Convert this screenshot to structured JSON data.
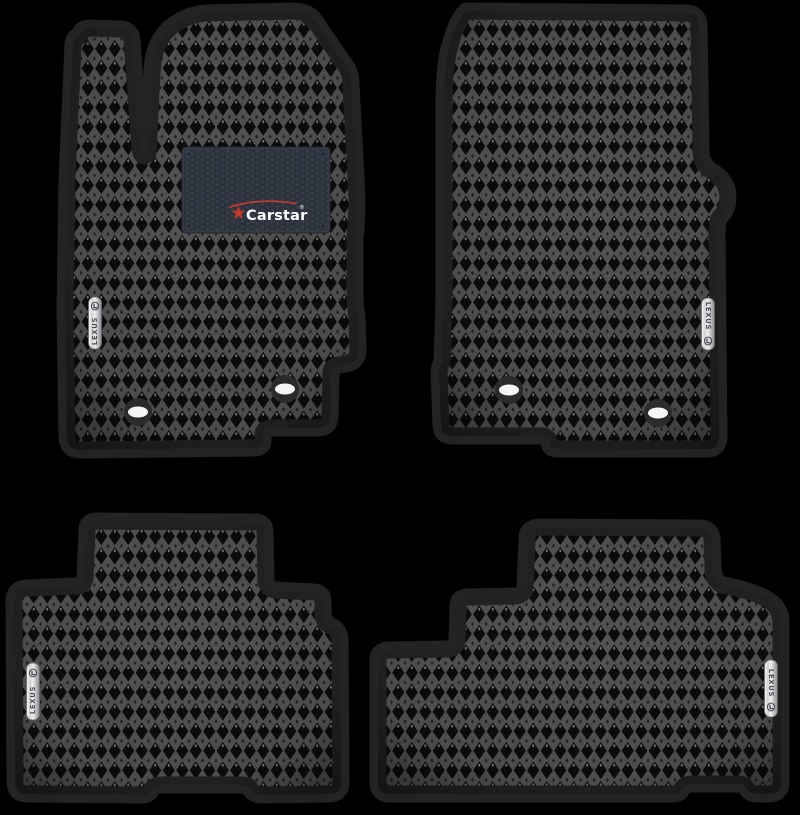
{
  "page": {
    "background_color": "#000000",
    "description": "Product photo: set of four black EVA car floor mats with rhombus pattern for a Lexus"
  },
  "branding": {
    "maker_label": {
      "text": "Carstar",
      "registered_mark": "®",
      "plate_color": "#353c47",
      "accent_color": "#c53a2e",
      "text_color": "#ffffff"
    },
    "car_brand_badge": {
      "text": "LEXUS",
      "finish": "silver-chrome",
      "logo": "lexus-l-in-ellipse"
    }
  },
  "mats": [
    {
      "id": "front-left",
      "label": "Driver front mat",
      "badge_text": "LEXUS",
      "fastener_holes": 2,
      "has_maker_label": true
    },
    {
      "id": "front-right",
      "label": "Passenger front mat",
      "badge_text": "LEXUS",
      "fastener_holes": 2,
      "has_maker_label": false
    },
    {
      "id": "rear-left",
      "label": "Rear left mat",
      "badge_text": "LEXUS",
      "fastener_holes": 0,
      "has_maker_label": false
    },
    {
      "id": "rear-right",
      "label": "Rear right mat",
      "badge_text": "LEXUS",
      "fastener_holes": 0,
      "has_maker_label": false
    }
  ],
  "materials": {
    "surface_pattern": "rhombus-eva",
    "surface_line_color": "#545454",
    "surface_cell_color": "#0c0c0c",
    "border_color": "#232323",
    "hole_ring_color": "#2b2b2b",
    "hole_center_color": "#f6f6f4"
  }
}
